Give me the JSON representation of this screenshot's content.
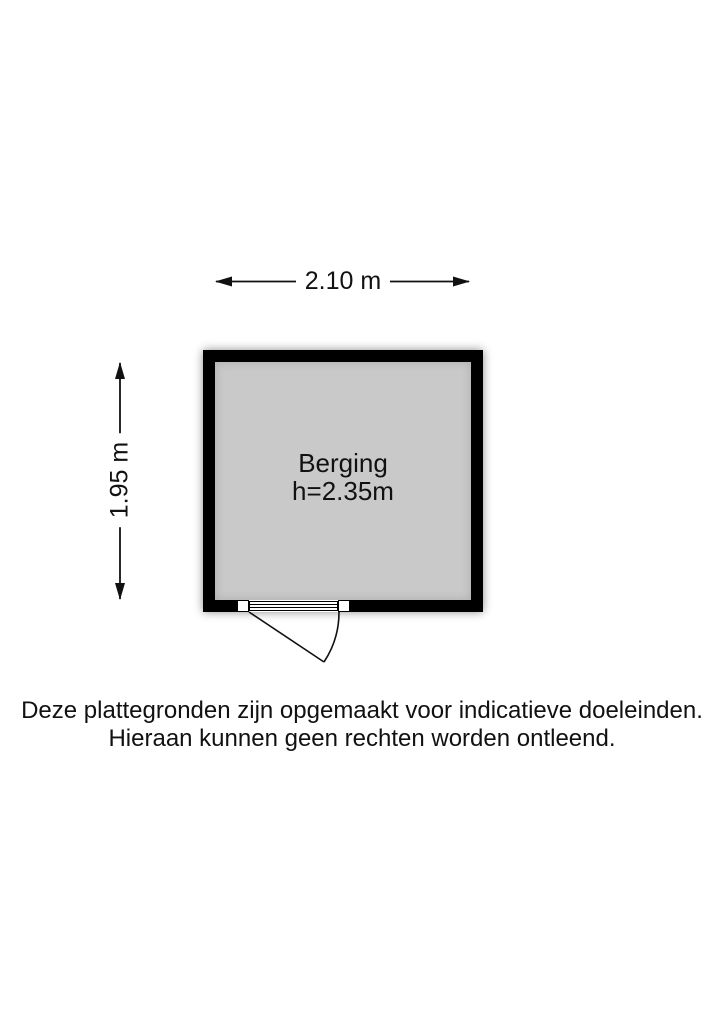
{
  "plan": {
    "room": {
      "name": "Berging",
      "height_label": "h=2.35m"
    },
    "dimensions": {
      "width_label": "2.10 m",
      "height_label": "1.95 m"
    },
    "colors": {
      "wall": "#000000",
      "floor": "#c9c9c9",
      "line": "#111111",
      "text": "#111111",
      "background": "#ffffff"
    }
  },
  "disclaimer": {
    "line1": "Deze plattegronden zijn opgemaakt voor indicatieve doeleinden.",
    "line2": "Hieraan kunnen geen rechten worden ontleend."
  }
}
